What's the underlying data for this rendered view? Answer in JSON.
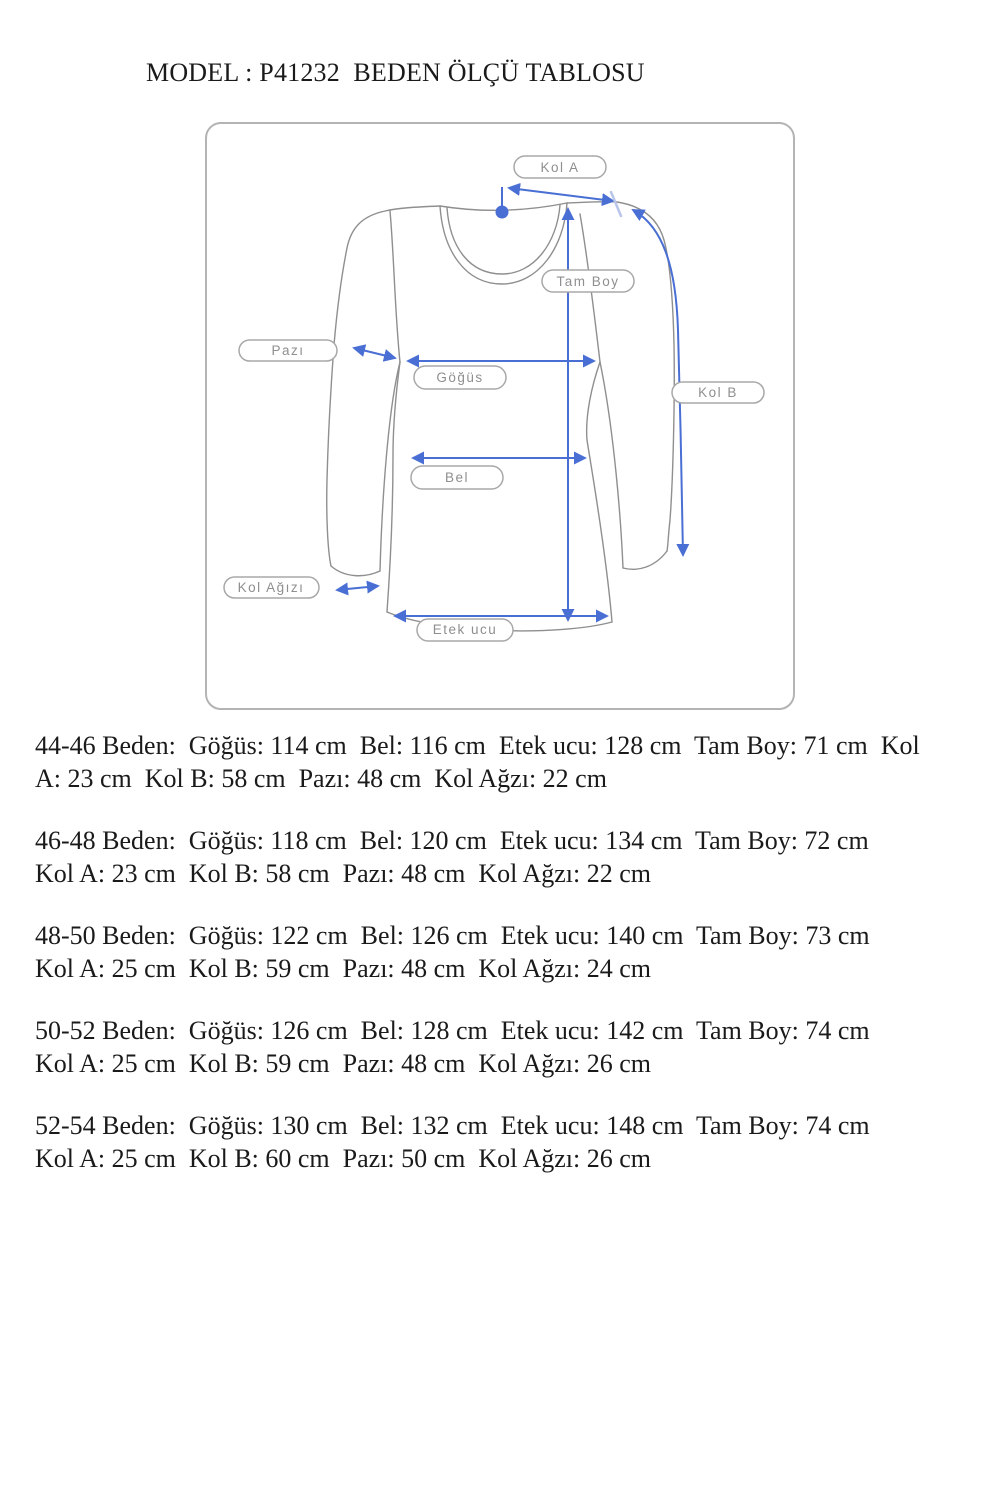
{
  "title": "MODEL : P41232  BEDEN ÖLÇÜ TABLOSU",
  "diagram": {
    "labels": {
      "kol_a": "Kol A",
      "tam_boy": "Tam Boy",
      "pazi": "Pazı",
      "gogus": "Göğüs",
      "kol_b": "Kol B",
      "bel": "Bel",
      "kol_agzi": "Kol Ağızı",
      "etek_ucu": "Etek ucu"
    },
    "colors": {
      "arrow": "#4a6fd4",
      "outline": "#8f8f8f",
      "pill_text": "#8f8f8f",
      "box_border": "#b4b4b4",
      "ink": "#1a1a1a"
    }
  },
  "size_table": [
    {
      "size": "44-46",
      "lines": [
        "44-46 Beden:  Göğüs: 114 cm  Bel: 116 cm  Etek ucu: 128 cm  Tam Boy: 71 cm  Kol",
        "A: 23 cm  Kol B: 58 cm  Pazı: 48 cm  Kol Ağzı: 22 cm"
      ],
      "measurements": {
        "gogus": "114 cm",
        "bel": "116 cm",
        "etek_ucu": "128 cm",
        "tam_boy": "71 cm",
        "kol_a": "23 cm",
        "kol_b": "58 cm",
        "pazi": "48 cm",
        "kol_agzi": "22 cm"
      }
    },
    {
      "size": "46-48",
      "lines": [
        "46-48 Beden:  Göğüs: 118 cm  Bel: 120 cm  Etek ucu: 134 cm  Tam Boy: 72 cm",
        "Kol A: 23 cm  Kol B: 58 cm  Pazı: 48 cm  Kol Ağzı: 22 cm"
      ],
      "measurements": {
        "gogus": "118 cm",
        "bel": "120 cm",
        "etek_ucu": "134 cm",
        "tam_boy": "72 cm",
        "kol_a": "23 cm",
        "kol_b": "58 cm",
        "pazi": "48 cm",
        "kol_agzi": "22 cm"
      }
    },
    {
      "size": "48-50",
      "lines": [
        "48-50 Beden:  Göğüs: 122 cm  Bel: 126 cm  Etek ucu: 140 cm  Tam Boy: 73 cm",
        "Kol A: 25 cm  Kol B: 59 cm  Pazı: 48 cm  Kol Ağzı: 24 cm"
      ],
      "measurements": {
        "gogus": "122 cm",
        "bel": "126 cm",
        "etek_ucu": "140 cm",
        "tam_boy": "73 cm",
        "kol_a": "25 cm",
        "kol_b": "59 cm",
        "pazi": "48 cm",
        "kol_agzi": "24 cm"
      }
    },
    {
      "size": "50-52",
      "lines": [
        "50-52 Beden:  Göğüs: 126 cm  Bel: 128 cm  Etek ucu: 142 cm  Tam Boy: 74 cm",
        "Kol A: 25 cm  Kol B: 59 cm  Pazı: 48 cm  Kol Ağzı: 26 cm"
      ],
      "measurements": {
        "gogus": "126 cm",
        "bel": "128 cm",
        "etek_ucu": "142 cm",
        "tam_boy": "74 cm",
        "kol_a": "25 cm",
        "kol_b": "59 cm",
        "pazi": "48 cm",
        "kol_agzi": "26 cm"
      }
    },
    {
      "size": "52-54",
      "lines": [
        "52-54 Beden:  Göğüs: 130 cm  Bel: 132 cm  Etek ucu: 148 cm  Tam Boy: 74 cm",
        "Kol A: 25 cm  Kol B: 60 cm  Pazı: 50 cm  Kol Ağzı: 26 cm"
      ],
      "measurements": {
        "gogus": "130 cm",
        "bel": "132 cm",
        "etek_ucu": "148 cm",
        "tam_boy": "74 cm",
        "kol_a": "25 cm",
        "kol_b": "60 cm",
        "pazi": "50 cm",
        "kol_agzi": "26 cm"
      }
    }
  ]
}
